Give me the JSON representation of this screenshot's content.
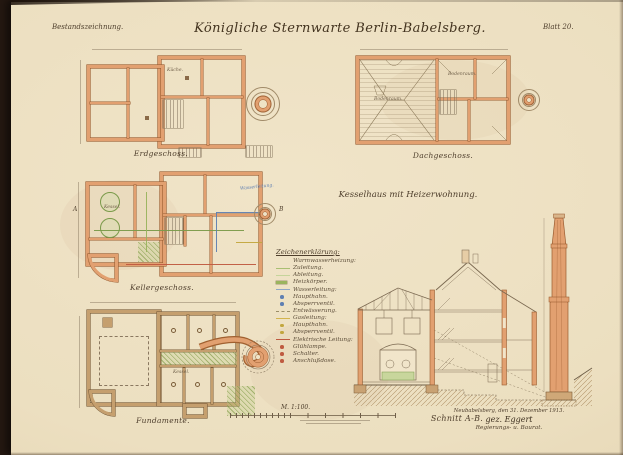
{
  "sheet": {
    "doc_type": "Bestandszeichnung.",
    "title": "Königliche Sternwarte Berlin-Babelsberg.",
    "sheet_no": "Blatt 20.",
    "subtitle": "Kesselhaus mit Heizerwohnung."
  },
  "plans": {
    "erdgeschoss_label": "Erdgeschoss.",
    "dachgeschoss_label": "Dachgeschoss.",
    "kellergeschoss_label": "Kellergeschoss.",
    "fundamente_label": "Fundamente.",
    "schnitt_label": "Schnitt A-B."
  },
  "room_labels": {
    "kueche": "Küche.",
    "bodenraum": "Bodenraum.",
    "kessel": "Kessel.",
    "wasserleitung_note": "Wasserleitung."
  },
  "section_markers": {
    "a": "A",
    "b": "B"
  },
  "legend": {
    "heading": "Zeichenerklärung:",
    "entries": [
      {
        "label": "Warmwasserheizung:",
        "swatch": "none",
        "color": ""
      },
      {
        "label": "Zuleitung.",
        "swatch": "line",
        "color": "#a9bf72"
      },
      {
        "label": "Ableitung.",
        "swatch": "line",
        "color": "#c5d49a"
      },
      {
        "label": "Heizkörper.",
        "swatch": "box",
        "color": "#9ab45e"
      },
      {
        "label": "Wasserleitung:",
        "swatch": "line",
        "color": "#8fa6c6"
      },
      {
        "label": "Haupthahn.",
        "swatch": "dot",
        "color": "#5f7fb2"
      },
      {
        "label": "Absperrventil.",
        "swatch": "dot",
        "color": "#5f7fb2"
      },
      {
        "label": "Entwässerung.",
        "swatch": "dashed",
        "color": "#9a8d68"
      },
      {
        "label": "Gasleitung:",
        "swatch": "line",
        "color": "#d2b44e"
      },
      {
        "label": "Haupthahn.",
        "swatch": "dot",
        "color": "#c2a63e"
      },
      {
        "label": "Absperrventil.",
        "swatch": "dot",
        "color": "#c2a63e"
      },
      {
        "label": "Elektrische Leitung:",
        "swatch": "line",
        "color": "#bf5a40"
      },
      {
        "label": "Glühlampe.",
        "swatch": "dot",
        "color": "#bf5a40"
      },
      {
        "label": "Schalter.",
        "swatch": "dot",
        "color": "#bf5a40"
      },
      {
        "label": "Anschlußdose.",
        "swatch": "dot",
        "color": "#bf5a40"
      }
    ]
  },
  "scale": {
    "label": "M. 1:100."
  },
  "signature": {
    "place_date": "Neubabelsberg, den 31. Dezember 1913.",
    "signed": "gez. Eggert",
    "title": "Regierungs- u. Baurat."
  },
  "colors": {
    "paper": "#ece0c1",
    "backing": "#241811",
    "wall_masonry": "#e2a070",
    "wall_foundation": "#c59f6e",
    "heating_green": "#9ab45e",
    "water_blue": "#5f7fb2",
    "gas_yellow": "#c2a63e",
    "electric_red": "#bf5a40",
    "ink": "#6f5f49"
  }
}
